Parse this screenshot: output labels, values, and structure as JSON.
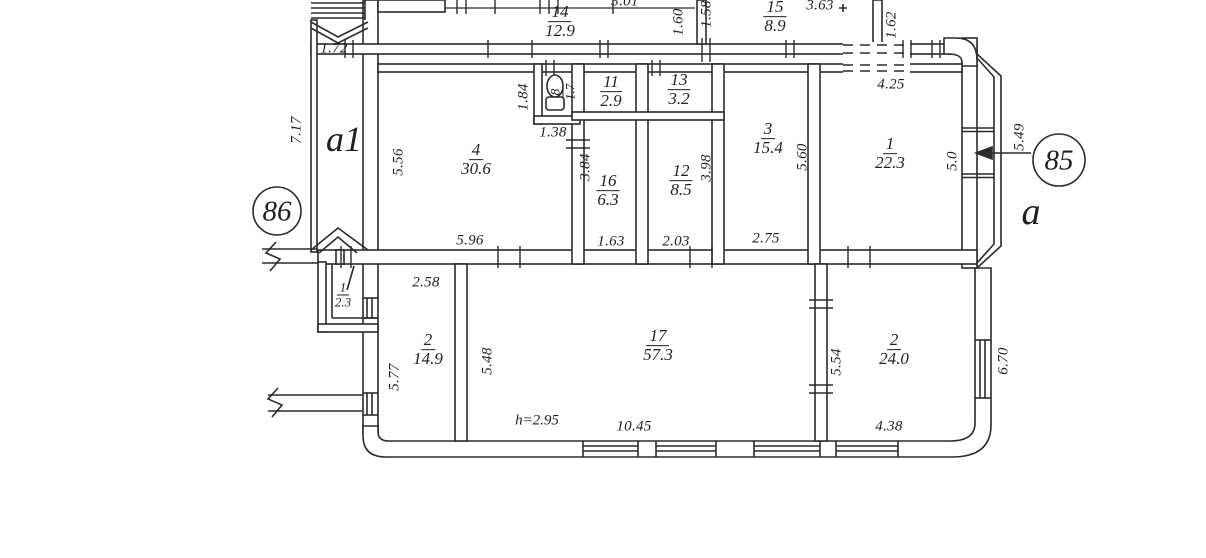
{
  "markers": {
    "m86": "86",
    "m85": "85"
  },
  "letters": {
    "a1": "a1",
    "a": "a"
  },
  "note": {
    "height": "h=2.95"
  },
  "rooms": {
    "r14": {
      "num": "14",
      "area": "12.9"
    },
    "r15": {
      "num": "15",
      "area": "8.9"
    },
    "r8": {
      "num": "8",
      "area": "1.7"
    },
    "r11": {
      "num": "11",
      "area": "2.9"
    },
    "r13": {
      "num": "13",
      "area": "3.2"
    },
    "r4": {
      "num": "4",
      "area": "30.6"
    },
    "r16": {
      "num": "16",
      "area": "6.3"
    },
    "r12": {
      "num": "12",
      "area": "8.5"
    },
    "r3": {
      "num": "3",
      "area": "15.4"
    },
    "r1main": {
      "num": "1",
      "area": "22.3"
    },
    "r1small": {
      "num": "1",
      "area": "2.3"
    },
    "r2left": {
      "num": "2",
      "area": "14.9"
    },
    "r17": {
      "num": "17",
      "area": "57.3"
    },
    "r2right": {
      "num": "2",
      "area": "24.0"
    }
  },
  "dims": {
    "d172": "1.72",
    "d717": "7.17",
    "d556": "5.56",
    "d184": "1.84",
    "d138": "1.38",
    "d301": "3.01",
    "d363": "3.63",
    "d160": "1.60",
    "d158": "1.58",
    "d162": "1.62",
    "d384": "3.84",
    "d398": "3.98",
    "d560": "5.60",
    "d425": "4.25",
    "d50": "5.0",
    "d549": "5.49",
    "d596": "5.96",
    "d163": "1.63",
    "d203": "2.03",
    "d275": "2.75",
    "d258": "2.58",
    "d577": "5.77",
    "d548": "5.48",
    "d554": "5.54",
    "d670": "6.70",
    "d1045": "10.45",
    "d438": "4.38"
  }
}
